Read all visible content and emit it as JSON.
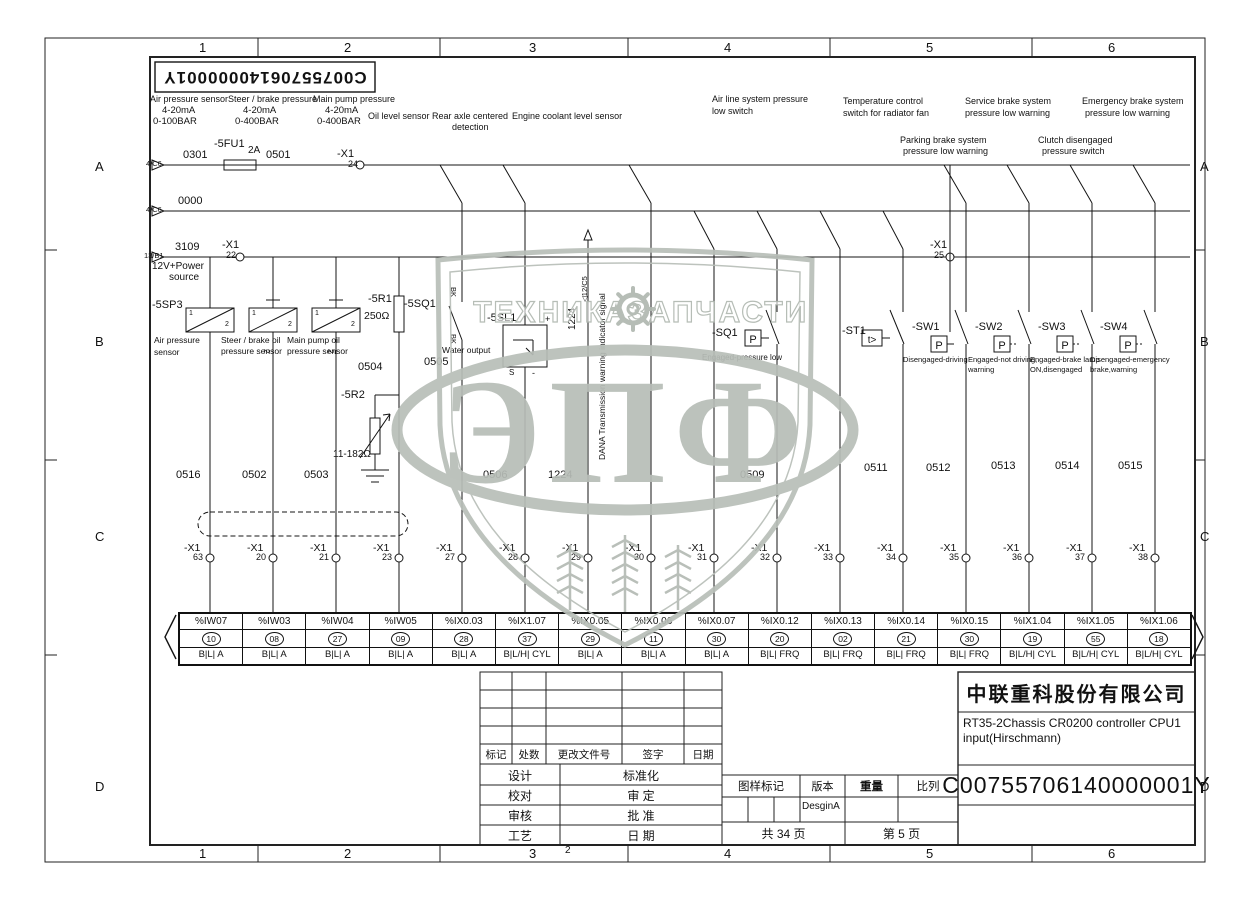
{
  "drawing": {
    "company": "中联重科股份有限公司",
    "title_line1": "RT35-2Chassis CR0200 controller CPU1",
    "title_line2": "input(Hirschmann)",
    "number": "C00755706140000001Y",
    "number_mirrored": "C00755706140000001Y",
    "total_pages": "共 34 页",
    "page": "第 5 页",
    "version_value": "DesginA",
    "rev_headers": [
      "标记",
      "处数",
      "更改文件号",
      "签字",
      "日期"
    ],
    "sign_rows": [
      {
        "l": "设计",
        "r": "标准化"
      },
      {
        "l": "校对",
        "r": "审 定"
      },
      {
        "l": "审核",
        "r": "批 准"
      },
      {
        "l": "工艺",
        "r": "日 期"
      }
    ],
    "stamp": {
      "mark": "图样标记",
      "version": "版本",
      "weight": "重量",
      "scale": "比列"
    }
  },
  "frame": {
    "columns": [
      "1",
      "2",
      "3",
      "4",
      "5",
      "6"
    ],
    "rows": [
      "A",
      "B",
      "C",
      "D"
    ]
  },
  "watermark": {
    "left": "ТЕХНИКА",
    "right": "ЗАПЧАСТИ",
    "big": "ЭПФ"
  },
  "symbols": {
    "pressure": "P",
    "temperature": "t>"
  },
  "colors": {
    "line": "#141414",
    "watermark": "#b8beb8"
  },
  "plc": {
    "columns": [
      {
        "addr": "%IW07",
        "pin": "10",
        "type": "B|L| A"
      },
      {
        "addr": "%IW03",
        "pin": "08",
        "type": "B|L| A"
      },
      {
        "addr": "%IW04",
        "pin": "27",
        "type": "B|L| A"
      },
      {
        "addr": "%IW05",
        "pin": "09",
        "type": "B|L| A"
      },
      {
        "addr": "%IX0.03",
        "pin": "28",
        "type": "B|L| A"
      },
      {
        "addr": "%IX1.07",
        "pin": "37",
        "type": "B|L/H| CYL"
      },
      {
        "addr": "%IX0.05",
        "pin": "29",
        "type": "B|L| A"
      },
      {
        "addr": "%IX0.06",
        "pin": "11",
        "type": "B|L| A"
      },
      {
        "addr": "%IX0.07",
        "pin": "30",
        "type": "B|L| A"
      },
      {
        "addr": "%IX0.12",
        "pin": "20",
        "type": "B|L| FRQ"
      },
      {
        "addr": "%IX0.13",
        "pin": "02",
        "type": "B|L| FRQ"
      },
      {
        "addr": "%IX0.14",
        "pin": "21",
        "type": "B|L| FRQ"
      },
      {
        "addr": "%IX0.15",
        "pin": "30",
        "type": "B|L| FRQ"
      },
      {
        "addr": "%IX1.04",
        "pin": "19",
        "type": "B|L/H| CYL"
      },
      {
        "addr": "%IX1.05",
        "pin": "55",
        "type": "B|L/H| CYL"
      },
      {
        "addr": "%IX1.06",
        "pin": "18",
        "type": "B|L/H| CYL"
      }
    ]
  },
  "terminals": {
    "prefix": "-X1",
    "items": [
      {
        "x": 210,
        "n": "63"
      },
      {
        "x": 273,
        "n": "20"
      },
      {
        "x": 336,
        "n": "21"
      },
      {
        "x": 399,
        "n": "23"
      },
      {
        "x": 462,
        "n": "27"
      },
      {
        "x": 525,
        "n": "28"
      },
      {
        "x": 588,
        "n": "29"
      },
      {
        "x": 651,
        "n": "30"
      },
      {
        "x": 714,
        "n": "31"
      },
      {
        "x": 777,
        "n": "32"
      },
      {
        "x": 840,
        "n": "33"
      },
      {
        "x": 903,
        "n": "34"
      },
      {
        "x": 966,
        "n": "35"
      },
      {
        "x": 1029,
        "n": "36"
      },
      {
        "x": 1092,
        "n": "37"
      },
      {
        "x": 1155,
        "n": "38"
      }
    ]
  },
  "labels": [
    {
      "n": "label-air-pressure-sensor",
      "t": "Air pressure sensor",
      "x": 150,
      "y": 95,
      "fs": 9
    },
    {
      "n": "label-air-range-ma",
      "t": "4-20mA",
      "x": 162,
      "y": 106,
      "fs": 9.5
    },
    {
      "n": "label-air-range-bar",
      "t": "0-100BAR",
      "x": 153,
      "y": 117,
      "fs": 9.5
    },
    {
      "n": "label-steer-brake-pressure",
      "t": "Steer / brake pressure",
      "x": 228,
      "y": 95,
      "fs": 9
    },
    {
      "n": "label-steer-range-ma",
      "t": "4-20mA",
      "x": 243,
      "y": 106,
      "fs": 9.5
    },
    {
      "n": "label-steer-range-bar",
      "t": "0-400BAR",
      "x": 235,
      "y": 117,
      "fs": 9.5
    },
    {
      "n": "label-main-pump-pressure",
      "t": "Main pump pressure",
      "x": 313,
      "y": 95,
      "fs": 9
    },
    {
      "n": "label-pump-range-ma",
      "t": "4-20mA",
      "x": 325,
      "y": 106,
      "fs": 9.5
    },
    {
      "n": "label-pump-range-bar",
      "t": "0-400BAR",
      "x": 317,
      "y": 117,
      "fs": 9.5
    },
    {
      "n": "label-oil-level-sensor",
      "t": "Oil level sensor",
      "x": 368,
      "y": 112,
      "fs": 9
    },
    {
      "n": "label-rear-axle-1",
      "t": "Rear axle centered",
      "x": 432,
      "y": 112,
      "fs": 9
    },
    {
      "n": "label-rear-axle-2",
      "t": "detection",
      "x": 452,
      "y": 123,
      "fs": 9
    },
    {
      "n": "label-engine-coolant",
      "t": "Engine coolant level sensor",
      "x": 512,
      "y": 112,
      "fs": 9
    },
    {
      "n": "label-air-line-1",
      "t": "Air line system pressure",
      "x": 712,
      "y": 95,
      "fs": 9
    },
    {
      "n": "label-air-line-2",
      "t": "low switch",
      "x": 712,
      "y": 107,
      "fs": 9
    },
    {
      "n": "label-temp-control-1",
      "t": "Temperature control",
      "x": 843,
      "y": 97,
      "fs": 9
    },
    {
      "n": "label-temp-control-2",
      "t": "switch for radiator fan",
      "x": 843,
      "y": 109,
      "fs": 9
    },
    {
      "n": "label-service-brake-1",
      "t": "Service brake system",
      "x": 965,
      "y": 97,
      "fs": 9
    },
    {
      "n": "label-service-brake-2",
      "t": "pressure low warning",
      "x": 965,
      "y": 109,
      "fs": 9
    },
    {
      "n": "label-emergency-brake-1",
      "t": "Emergency brake system",
      "x": 1082,
      "y": 97,
      "fs": 9
    },
    {
      "n": "label-emergency-brake-2",
      "t": "pressure low warning",
      "x": 1085,
      "y": 109,
      "fs": 9
    },
    {
      "n": "label-parking-brake-1",
      "t": "Parking brake system",
      "x": 900,
      "y": 136,
      "fs": 9
    },
    {
      "n": "label-parking-brake-2",
      "t": "pressure low warning",
      "x": 903,
      "y": 147,
      "fs": 9
    },
    {
      "n": "label-clutch-1",
      "t": "Clutch disengaged",
      "x": 1038,
      "y": 136,
      "fs": 9
    },
    {
      "n": "label-clutch-2",
      "t": "pressure switch",
      "x": 1042,
      "y": 147,
      "fs": 9
    },
    {
      "n": "ref-4C6-a",
      "t": "4/C6",
      "x": 146,
      "y": 160,
      "fs": 7.5
    },
    {
      "n": "wire-0301",
      "t": "0301",
      "x": 183,
      "y": 150,
      "fs": 11
    },
    {
      "n": "comp-5FU1",
      "t": "-5FU1",
      "x": 214,
      "y": 139,
      "fs": 11
    },
    {
      "n": "comp-5FU1-rating",
      "t": "2A",
      "x": 248,
      "y": 146,
      "fs": 10
    },
    {
      "n": "wire-0501",
      "t": "0501",
      "x": 266,
      "y": 150,
      "fs": 11
    },
    {
      "n": "term-X1-24-name",
      "t": "-X1",
      "x": 337,
      "y": 149,
      "fs": 11
    },
    {
      "n": "term-X1-24-pin",
      "t": "24",
      "x": 348,
      "y": 160,
      "fs": 9
    },
    {
      "n": "ref-4C6-b",
      "t": "4/C6",
      "x": 146,
      "y": 206,
      "fs": 7.5
    },
    {
      "n": "wire-0000",
      "t": "0000",
      "x": 178,
      "y": 196,
      "fs": 11
    },
    {
      "n": "ref-13B1",
      "t": "13/B1",
      "x": 144,
      "y": 252,
      "fs": 7.5
    },
    {
      "n": "wire-3109",
      "t": "3109",
      "x": 175,
      "y": 242,
      "fs": 11
    },
    {
      "n": "term-X1-22-name",
      "t": "-X1",
      "x": 222,
      "y": 240,
      "fs": 11
    },
    {
      "n": "term-X1-22-pin",
      "t": "22",
      "x": 226,
      "y": 251,
      "fs": 9
    },
    {
      "n": "label-power-source-1",
      "t": "12V+Power",
      "x": 152,
      "y": 262,
      "fs": 10
    },
    {
      "n": "label-power-source-2",
      "t": "source",
      "x": 169,
      "y": 273,
      "fs": 10
    },
    {
      "n": "term-X1-25-name",
      "t": "-X1",
      "x": 930,
      "y": 240,
      "fs": 11
    },
    {
      "n": "term-X1-25-pin",
      "t": "25",
      "x": 934,
      "y": 251,
      "fs": 9
    },
    {
      "n": "comp-5SP3",
      "t": "-5SP3",
      "x": 152,
      "y": 300,
      "fs": 11
    },
    {
      "n": "pin-1a",
      "t": "1",
      "x": 189,
      "y": 310,
      "fs": 7
    },
    {
      "n": "pin-2a",
      "t": "2",
      "x": 225,
      "y": 321,
      "fs": 7
    },
    {
      "n": "pin-1b",
      "t": "1",
      "x": 252,
      "y": 310,
      "fs": 7
    },
    {
      "n": "pin-2b",
      "t": "2",
      "x": 288,
      "y": 321,
      "fs": 7
    },
    {
      "n": "pin-1c",
      "t": "1",
      "x": 315,
      "y": 310,
      "fs": 7
    },
    {
      "n": "pin-2c",
      "t": "2",
      "x": 351,
      "y": 321,
      "fs": 7
    },
    {
      "n": "label-air-sensor-1",
      "t": "Air pressure",
      "x": 154,
      "y": 336,
      "fs": 8.5
    },
    {
      "n": "label-air-sensor-2",
      "t": "sensor",
      "x": 154,
      "y": 348,
      "fs": 8.5
    },
    {
      "n": "label-steer-sensor-1",
      "t": "Steer / brake oil",
      "x": 221,
      "y": 336,
      "fs": 8.5
    },
    {
      "n": "label-steer-sensor-2",
      "t": "pressure sensor",
      "x": 221,
      "y": 347,
      "fs": 8.5
    },
    {
      "n": "label-steer-sensor-wire2",
      "t": "2",
      "x": 270,
      "y": 349,
      "fs": 8,
      "rot": 90
    },
    {
      "n": "label-pump-sensor-1",
      "t": "Main pump oil",
      "x": 287,
      "y": 336,
      "fs": 8.5
    },
    {
      "n": "label-pump-sensor-2",
      "t": "pressure sensor",
      "x": 287,
      "y": 347,
      "fs": 8.5
    },
    {
      "n": "label-pump-sensor-wire2",
      "t": "2",
      "x": 334,
      "y": 349,
      "fs": 8,
      "rot": 90
    },
    {
      "n": "comp-5R1",
      "t": "-5R1",
      "x": 368,
      "y": 294,
      "fs": 11
    },
    {
      "n": "comp-5R1-value",
      "t": "250Ω",
      "x": 364,
      "y": 311,
      "fs": 10.5
    },
    {
      "n": "wire-0504",
      "t": "0504",
      "x": 358,
      "y": 362,
      "fs": 11
    },
    {
      "n": "comp-5R2",
      "t": "-5R2",
      "x": 341,
      "y": 390,
      "fs": 11
    },
    {
      "n": "comp-5R2-value",
      "t": "11-182Ω",
      "x": 333,
      "y": 450,
      "fs": 10
    },
    {
      "n": "comp-5SQ1",
      "t": "-5SQ1",
      "x": 404,
      "y": 299,
      "fs": 11
    },
    {
      "n": "wire-color-bk-1",
      "t": "BK",
      "x": 457,
      "y": 287,
      "fs": 7.5,
      "rot": 90
    },
    {
      "n": "wire-color-bk-2",
      "t": "BK",
      "x": 457,
      "y": 334,
      "fs": 7.5,
      "rot": 90
    },
    {
      "n": "wire-0505",
      "t": "0505",
      "x": 424,
      "y": 357,
      "fs": 11
    },
    {
      "n": "comp-5SL1",
      "t": "-5SL1",
      "x": 487,
      "y": 313,
      "fs": 11
    },
    {
      "n": "label-water-output",
      "t": "Water output",
      "x": 442,
      "y": 346,
      "fs": 8.5
    },
    {
      "n": "label-5SL1-plus",
      "t": "+",
      "x": 545,
      "y": 315,
      "fs": 9
    },
    {
      "n": "label-5SL1-s",
      "t": "S",
      "x": 509,
      "y": 369,
      "fs": 8
    },
    {
      "n": "label-5SL1-minus",
      "t": "-",
      "x": 532,
      "y": 369,
      "fs": 9
    },
    {
      "n": "wire-0506",
      "t": "0506",
      "x": 483,
      "y": 470,
      "fs": 11
    },
    {
      "n": "wire-1224-vertical",
      "t": "1224",
      "x": 568,
      "y": 330,
      "fs": 10,
      "rot": -90
    },
    {
      "n": "ref-12C5",
      "t": "◁12/C5",
      "x": 581,
      "y": 302,
      "fs": 7.5,
      "rot": -90
    },
    {
      "n": "label-dana-signal",
      "t": "DANA Transmission warning indicator signal",
      "x": 598,
      "y": 460,
      "fs": 8.5,
      "rot": -90
    },
    {
      "n": "wire-1224",
      "t": "1224",
      "x": 548,
      "y": 470,
      "fs": 11
    },
    {
      "n": "comp-SQ1",
      "t": "-SQ1",
      "x": 712,
      "y": 328,
      "fs": 11
    },
    {
      "n": "label-SQ1-desc",
      "t": "Engaged-pressure low",
      "x": 702,
      "y": 354,
      "fs": 8
    },
    {
      "n": "wire-0509",
      "t": "0509",
      "x": 740,
      "y": 470,
      "fs": 11
    },
    {
      "n": "comp-ST1",
      "t": "-ST1",
      "x": 842,
      "y": 326,
      "fs": 11
    },
    {
      "n": "wire-0511",
      "t": "0511",
      "x": 864,
      "y": 463,
      "fs": 11
    },
    {
      "n": "comp-SW1",
      "t": "-SW1",
      "x": 912,
      "y": 322,
      "fs": 11
    },
    {
      "n": "label-SW1-desc",
      "t": "Disengaged-driving",
      "x": 903,
      "y": 356,
      "fs": 7.5
    },
    {
      "n": "wire-0512",
      "t": "0512",
      "x": 926,
      "y": 463,
      "fs": 11
    },
    {
      "n": "comp-SW2",
      "t": "-SW2",
      "x": 975,
      "y": 322,
      "fs": 11
    },
    {
      "n": "label-SW2-desc-1",
      "t": "Engaged-not driving,",
      "x": 968,
      "y": 356,
      "fs": 7.5
    },
    {
      "n": "label-SW2-desc-2",
      "t": "warning",
      "x": 968,
      "y": 366,
      "fs": 7.5
    },
    {
      "n": "wire-0513",
      "t": "0513",
      "x": 991,
      "y": 461,
      "fs": 11
    },
    {
      "n": "comp-SW3",
      "t": "-SW3",
      "x": 1038,
      "y": 322,
      "fs": 11
    },
    {
      "n": "label-SW3-desc-1",
      "t": "Engaged-brake lamp",
      "x": 1030,
      "y": 356,
      "fs": 7.5
    },
    {
      "n": "label-SW3-desc-2",
      "t": "ON,disengaged",
      "x": 1030,
      "y": 366,
      "fs": 7.5
    },
    {
      "n": "wire-0514",
      "t": "0514",
      "x": 1055,
      "y": 461,
      "fs": 11
    },
    {
      "n": "comp-SW4",
      "t": "-SW4",
      "x": 1100,
      "y": 322,
      "fs": 11
    },
    {
      "n": "label-SW4-desc-1",
      "t": "Disengaged-emergency",
      "x": 1090,
      "y": 356,
      "fs": 7.5
    },
    {
      "n": "label-SW4-desc-2",
      "t": "brake,warning",
      "x": 1090,
      "y": 366,
      "fs": 7.5
    },
    {
      "n": "wire-0515",
      "t": "0515",
      "x": 1118,
      "y": 461,
      "fs": 11
    },
    {
      "n": "wire-0516",
      "t": "0516",
      "x": 176,
      "y": 470,
      "fs": 11
    },
    {
      "n": "wire-0502",
      "t": "0502",
      "x": 242,
      "y": 470,
      "fs": 11
    },
    {
      "n": "wire-0503",
      "t": "0503",
      "x": 304,
      "y": 470,
      "fs": 11
    },
    {
      "n": "stray-mark-2",
      "t": "2",
      "x": 565,
      "y": 846,
      "fs": 10
    }
  ]
}
